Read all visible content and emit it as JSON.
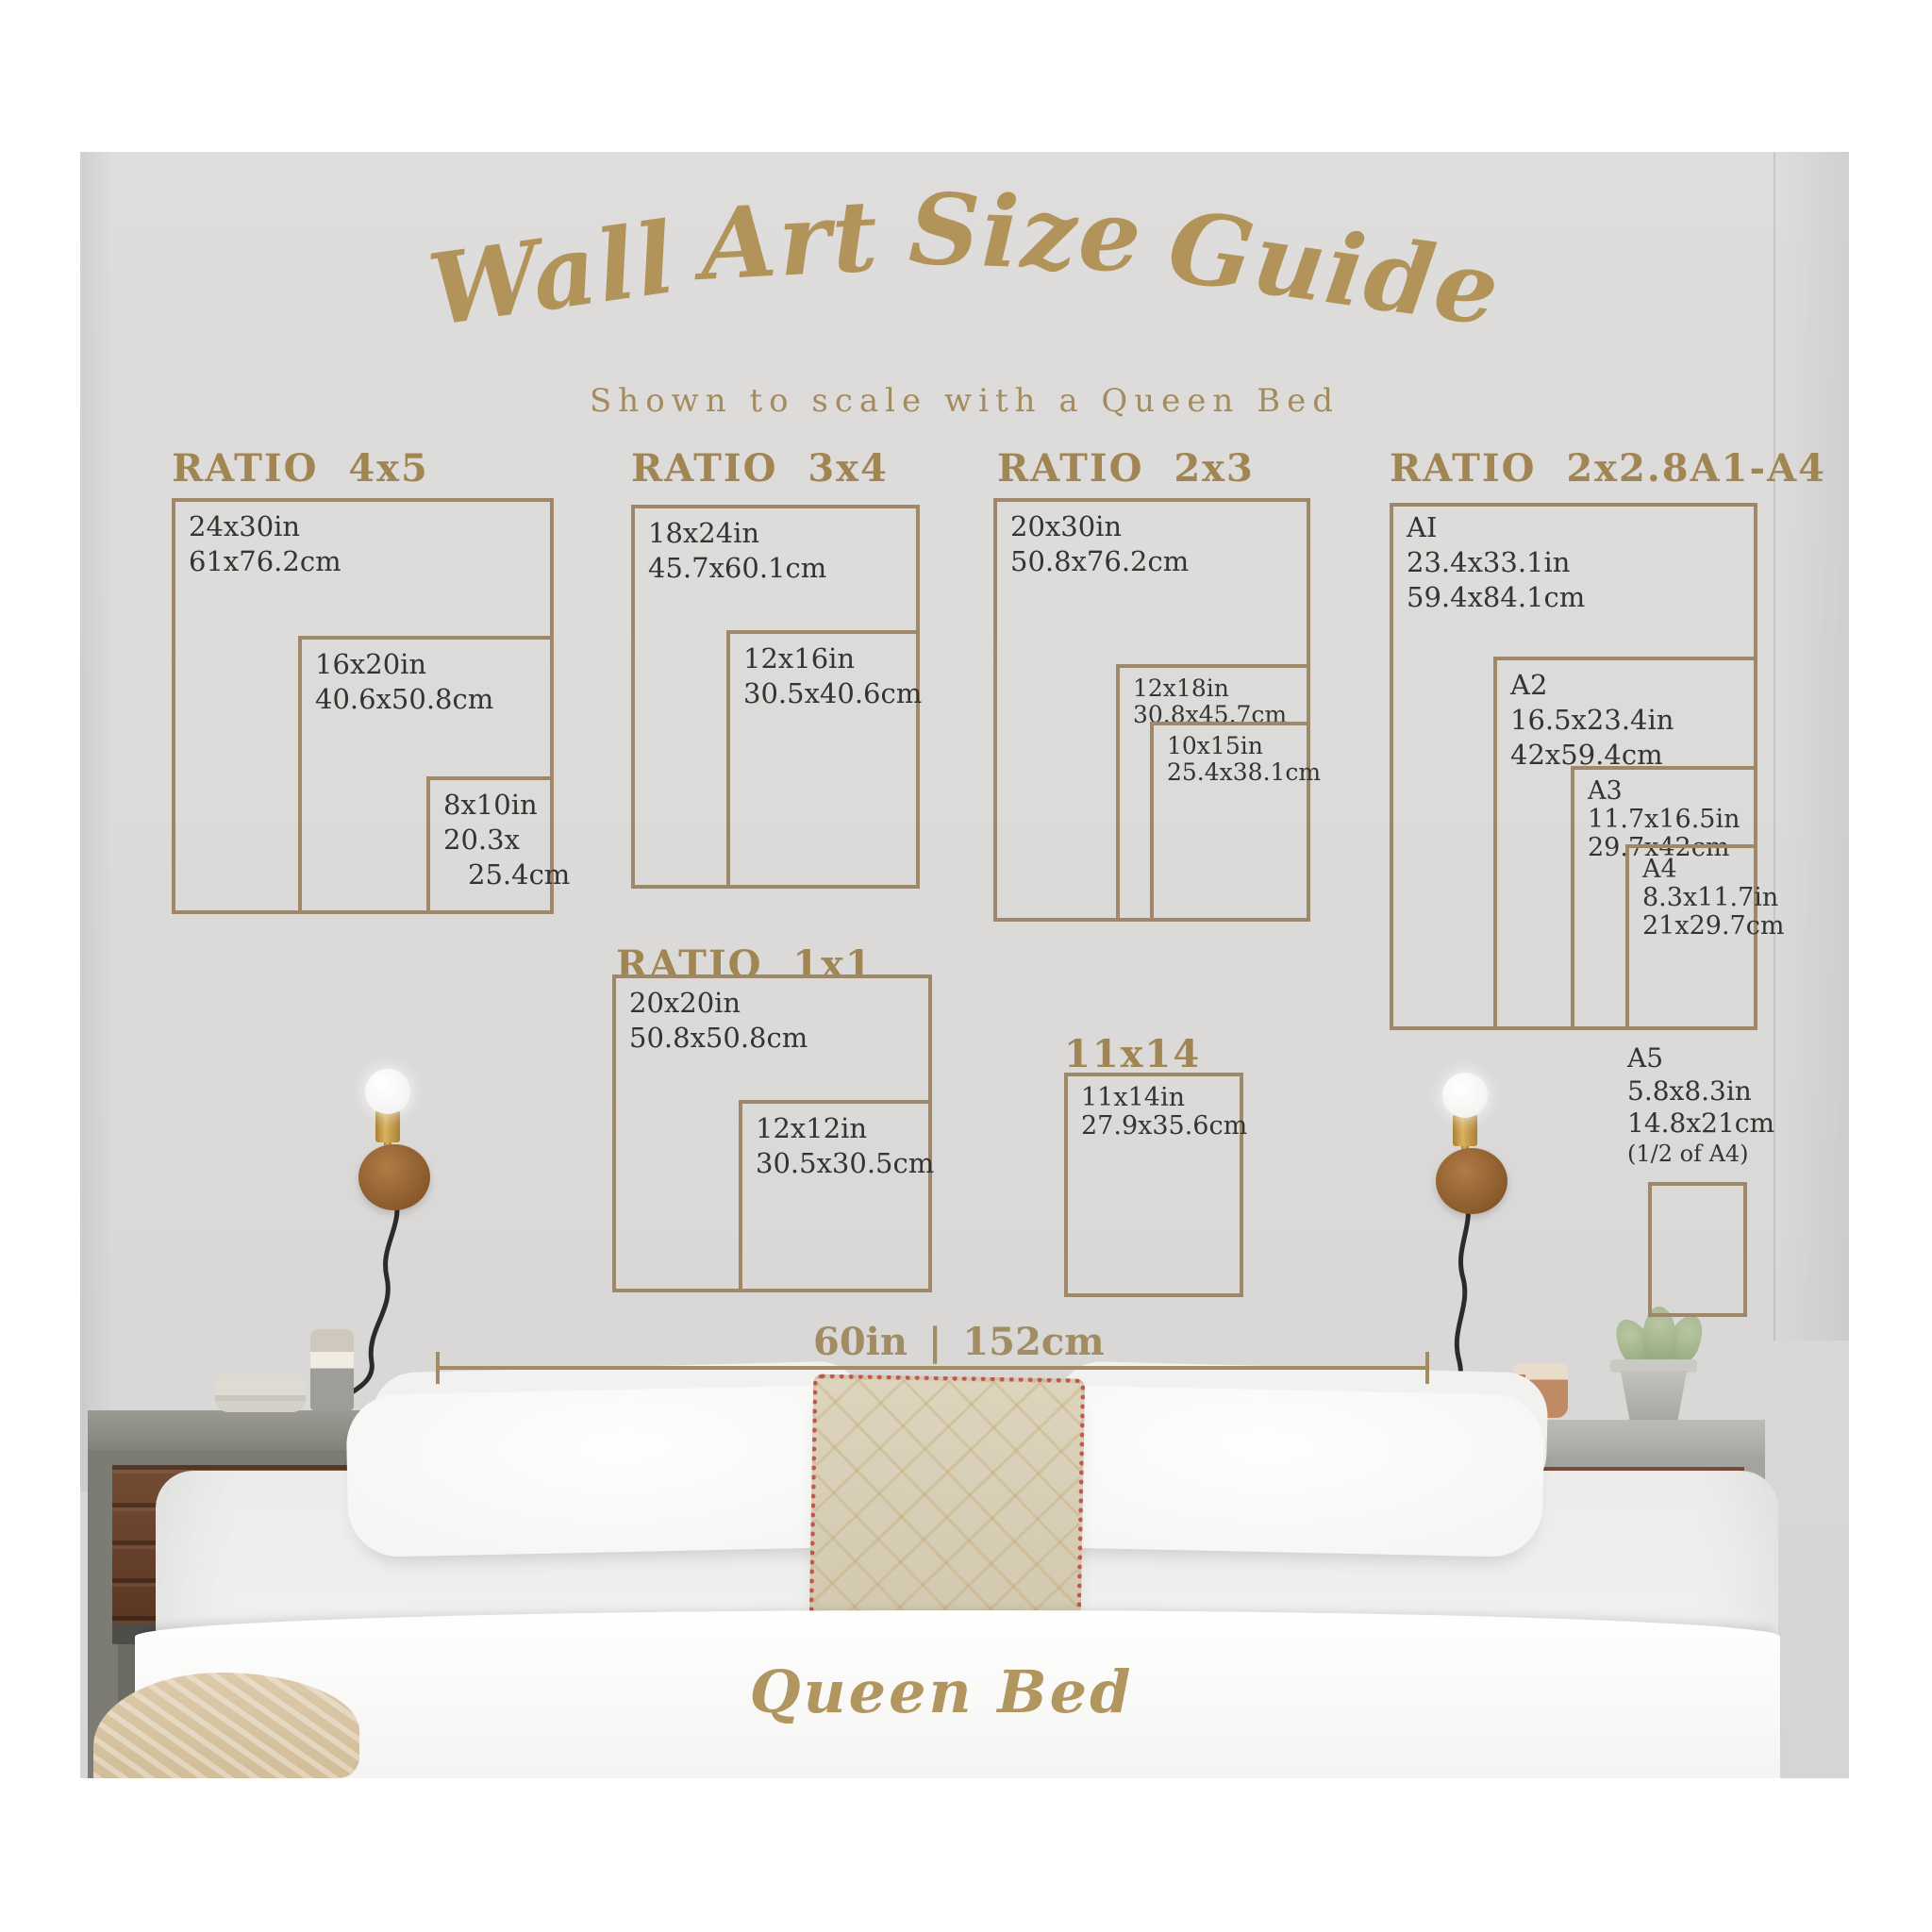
{
  "title_words": {
    "w1": "Wall",
    "w2": "Art",
    "w3": "Size",
    "w4": "Guide"
  },
  "subtitle": "Shown to scale with a Queen Bed",
  "colors": {
    "gold_accent": "#9f8769",
    "gold_heading": "#a18553",
    "gold_title": "#b2935a",
    "label_text": "#343432",
    "wall_gray": "#dbdad8"
  },
  "groups": {
    "r4x5": {
      "header": "RATIO  4x5",
      "boxes": {
        "b1": {
          "l1": "24x30in",
          "l2": "61x76.2cm"
        },
        "b2": {
          "l1": "16x20in",
          "l2": "40.6x50.8cm"
        },
        "b3": {
          "l1": "8x10in",
          "l2": "20.3x",
          "l3": "25.4cm"
        }
      }
    },
    "r3x4": {
      "header": "RATIO  3x4",
      "boxes": {
        "b1": {
          "l1": "18x24in",
          "l2": "45.7x60.1cm"
        },
        "b2": {
          "l1": "12x16in",
          "l2": "30.5x40.6cm"
        }
      }
    },
    "r2x3": {
      "header": "RATIO  2x3",
      "boxes": {
        "b1": {
          "l1": "20x30in",
          "l2": "50.8x76.2cm"
        },
        "b2": {
          "l1": "12x18in",
          "l2": "30.8x45.7cm"
        },
        "b3": {
          "l1": "10x15in",
          "l2": "25.4x38.1cm"
        }
      }
    },
    "r2x28": {
      "header": "RATIO  2x2.8",
      "header_right": "A1-A4",
      "boxes": {
        "a1": {
          "l1": "AI",
          "l2": "23.4x33.1in",
          "l3": "59.4x84.1cm"
        },
        "a2": {
          "l1": "A2",
          "l2": "16.5x23.4in",
          "l3": "42x59.4cm"
        },
        "a3": {
          "l1": "A3",
          "l2": "11.7x16.5in",
          "l3": "29.7x42cm"
        },
        "a4": {
          "l1": "A4",
          "l2": "8.3x11.7in",
          "l3": "21x29.7cm"
        },
        "a5": {
          "l1": "A5",
          "l2": "5.8x8.3in",
          "l3": "14.8x21cm",
          "l4": "(1/2 of A4)"
        }
      }
    },
    "r1x1": {
      "header": "RATIO  1x1",
      "boxes": {
        "b1": {
          "l1": "20x20in",
          "l2": "50.8x50.8cm"
        },
        "b2": {
          "l1": "12x12in",
          "l2": "30.5x30.5cm"
        }
      }
    },
    "r11x14": {
      "header": "11x14",
      "boxes": {
        "b1": {
          "l1": "11x14in",
          "l2": "27.9x35.6cm"
        }
      }
    }
  },
  "measurement": {
    "label": "60in | 152cm"
  },
  "bed_label": "Queen Bed"
}
